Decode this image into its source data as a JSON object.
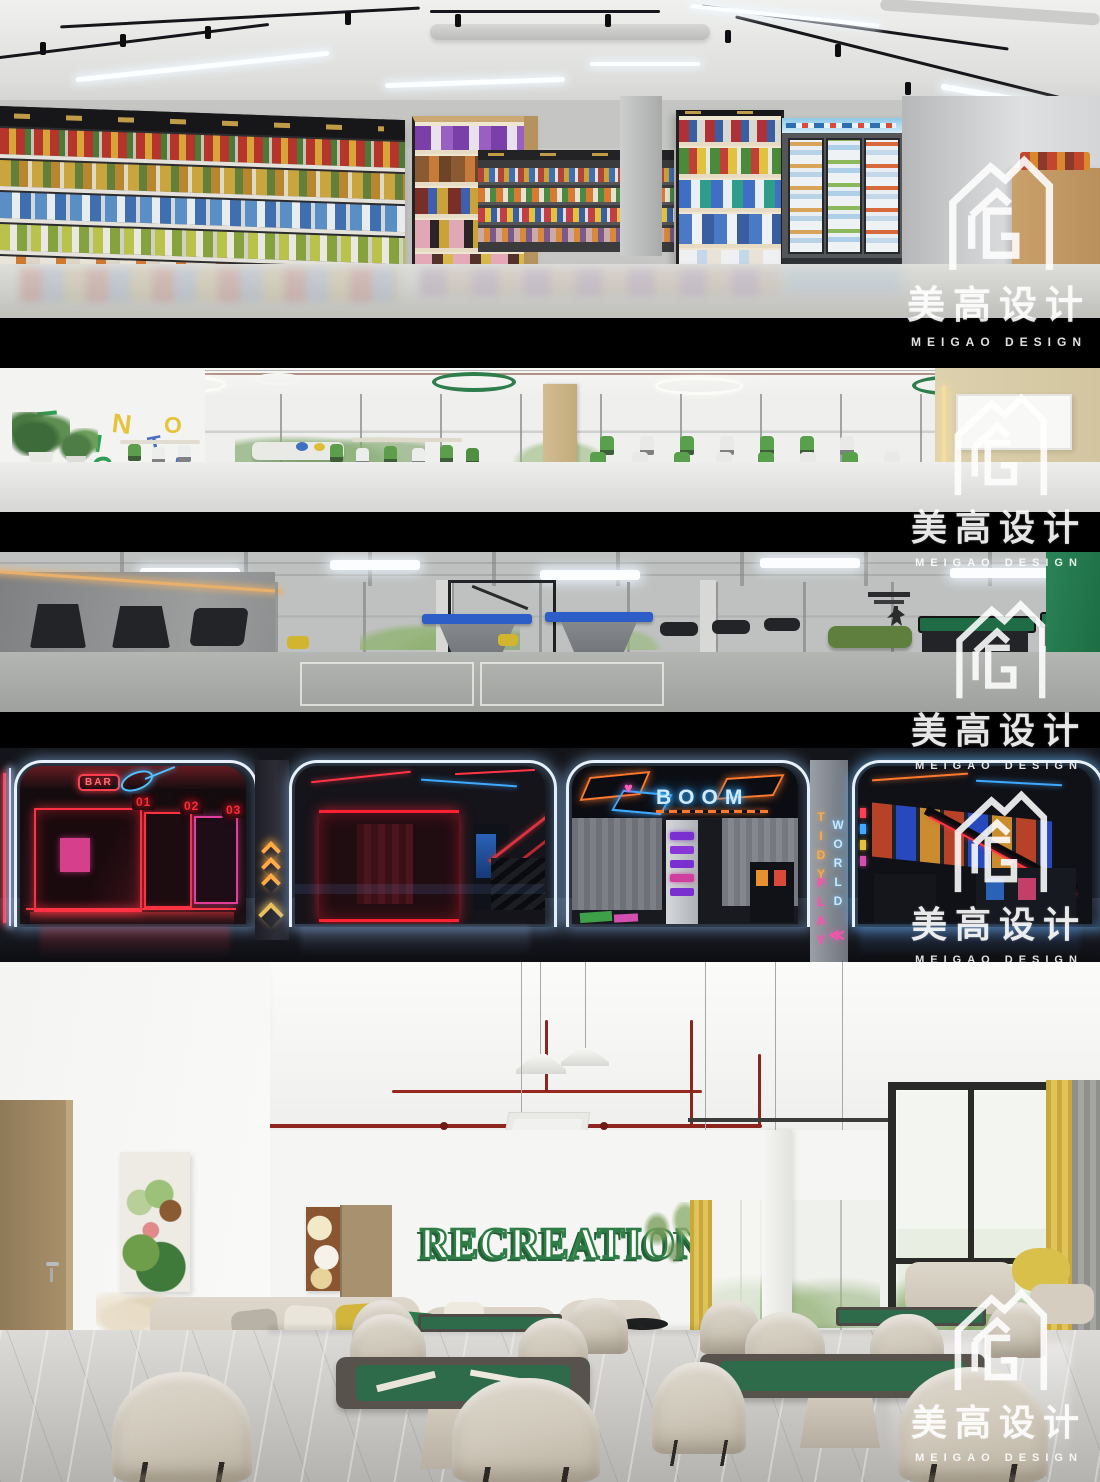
{
  "watermark": {
    "cn": "美高设计",
    "en": "MEIGAO DESIGN"
  },
  "cafeteria": {
    "wall_letters": [
      {
        "ch": "E",
        "color": "#2f9e52"
      },
      {
        "ch": "N",
        "color": "#e5c43c"
      },
      {
        "ch": "O",
        "color": "#e5c43c"
      },
      {
        "ch": "L",
        "color": "#2f9e52"
      },
      {
        "ch": "I",
        "color": "#2f9e52"
      },
      {
        "ch": "T",
        "color": "#4a6fbe"
      },
      {
        "ch": "C",
        "color": "#2f9e52"
      },
      {
        "ch": "N",
        "color": "#4a6fbe"
      },
      {
        "ch": "L",
        "color": "#4a6fbe"
      },
      {
        "ch": "J",
        "color": "#e5c43c"
      }
    ]
  },
  "arcade": {
    "bar_sign": "BAR",
    "booth_numbers": [
      "01",
      "02",
      "03"
    ],
    "boom_sign": "BOOM",
    "play_wall_words": [
      "TIDY",
      "PLAY",
      "WORLD"
    ],
    "arrow_glyph": "≪"
  },
  "recreation": {
    "wall_text": "RECREATION"
  },
  "colors": {
    "neon_red": "#ff2e3f",
    "neon_blue": "#5ad0ff",
    "neon_pink": "#ff43b4",
    "neon_orange": "#ffab45",
    "recreation_green": "#2e7d46",
    "gym_accent_green": "#1f7a4c"
  }
}
